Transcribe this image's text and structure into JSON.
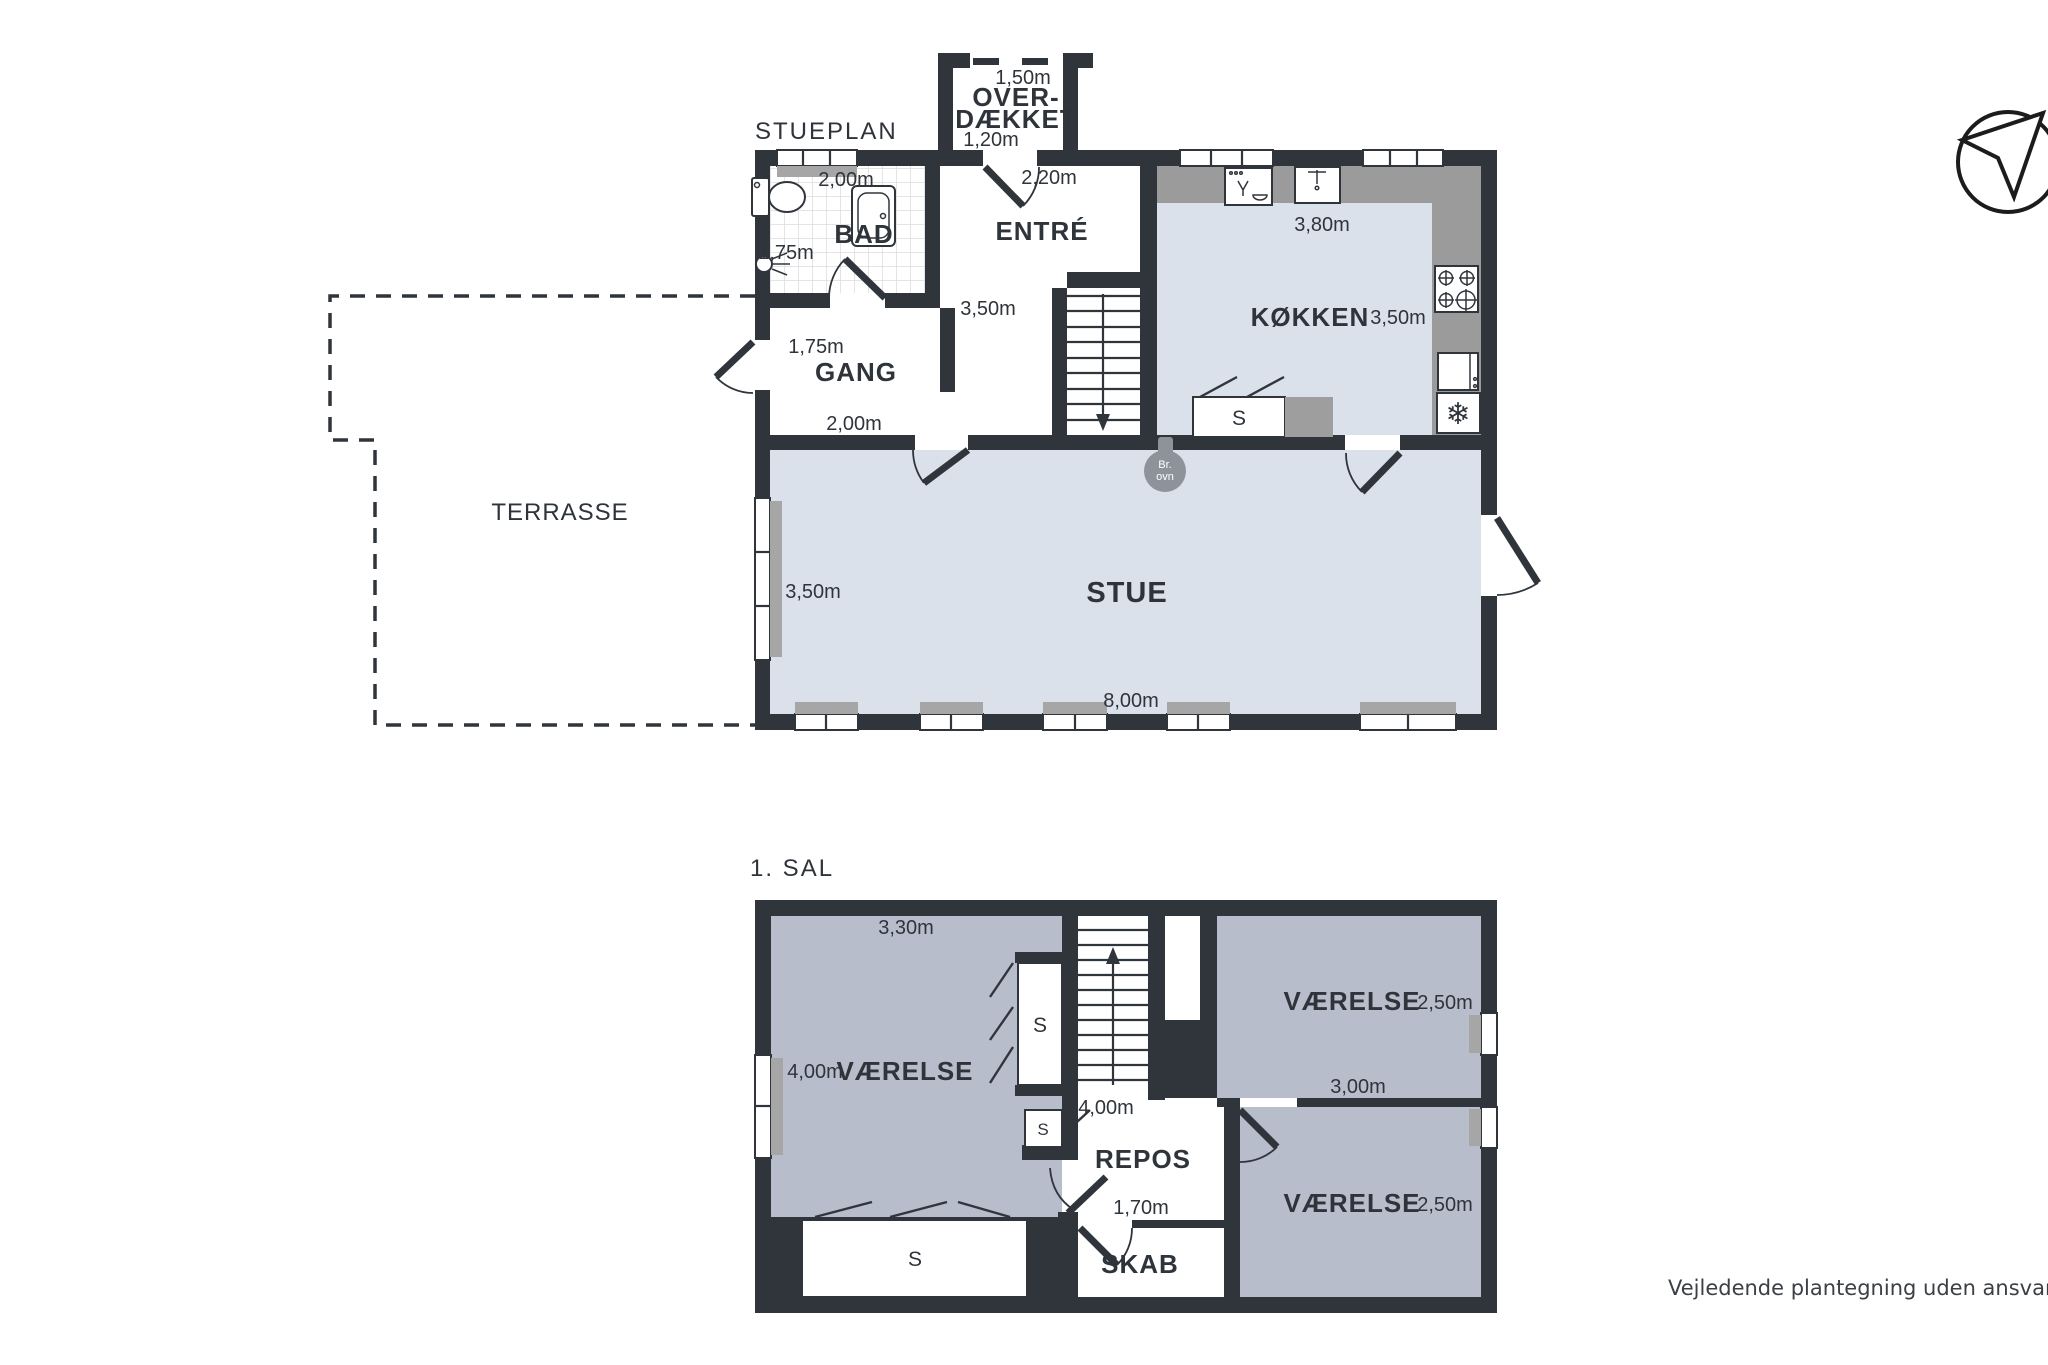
{
  "ground_floor": {
    "title": "STUEPLAN",
    "rooms": {
      "overdaekket": {
        "name_line1": "OVER-",
        "name_line2": "DÆKKET",
        "width": "1,50m",
        "depth": "1,20m"
      },
      "bad": {
        "name": "BAD",
        "width": "2,00m",
        "inner": "1,75m"
      },
      "entre": {
        "name": "ENTRÉ",
        "door": "2,20m",
        "depth": "3,50m"
      },
      "kokken": {
        "name": "KØKKEN",
        "width": "3,80m",
        "depth": "3,50m"
      },
      "gang": {
        "name": "GANG",
        "top": "1,75m",
        "width": "2,00m"
      },
      "stue": {
        "name": "STUE",
        "depth": "3,50m",
        "width": "8,00m"
      },
      "terrasse": {
        "name": "TERRASSE"
      }
    },
    "fixtures": {
      "closet": "S",
      "wood_stove_line1": "Br.",
      "wood_stove_line2": "ovn"
    }
  },
  "first_floor": {
    "title": "1. SAL",
    "rooms": {
      "vaerelse_left": {
        "name": "VÆRELSE",
        "width": "3,30m",
        "depth": "4,00m"
      },
      "repos": {
        "name": "REPOS",
        "width": "4,00m",
        "depth": "1,70m"
      },
      "skab": {
        "name": "SKAB"
      },
      "vaerelse_top_right": {
        "name": "VÆRELSE",
        "size": "2,50m",
        "width": "3,00m"
      },
      "vaerelse_bottom_right": {
        "name": "VÆRELSE",
        "size": "2,50m"
      }
    },
    "fixtures": {
      "closet": "S"
    }
  },
  "icons": {
    "snowflake": "❄"
  },
  "footer": {
    "disclaimer": "Vejledende plantegning uden ansvar"
  },
  "colors": {
    "wall": "#30353c",
    "floor_ground": "#dbe1ea",
    "floor_first": "#b7bdcb",
    "counter": "#9b9b9b",
    "sill": "#a6a6a6",
    "stove": "#8e939b",
    "text": "#2f343b"
  }
}
